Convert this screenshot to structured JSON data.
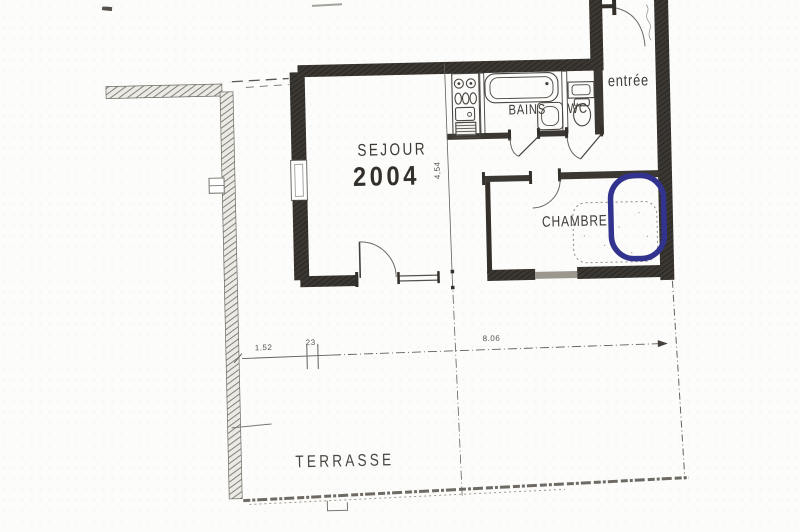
{
  "rooms": {
    "sejour": {
      "name": "SEJOUR",
      "number": "2004"
    },
    "bains": {
      "name": "BAINS"
    },
    "wc": {
      "name": "WC"
    },
    "entree": {
      "name": "entrée"
    },
    "chambre": {
      "name": "CHAMBRE"
    },
    "terrasse": {
      "name": "TERRASSE"
    }
  },
  "dimensions": {
    "terrasse_width_left": "1.52",
    "wall_thickness": "23",
    "terrasse_length": "8.06",
    "sejour_depth": "4,54"
  },
  "annotation": {
    "type": "hand-drawn-ring",
    "color": "#32338e"
  },
  "colors": {
    "paper": "#fcfcfa",
    "ink": "#44423e",
    "wall": "#3b3732",
    "blue": "#32338e"
  }
}
